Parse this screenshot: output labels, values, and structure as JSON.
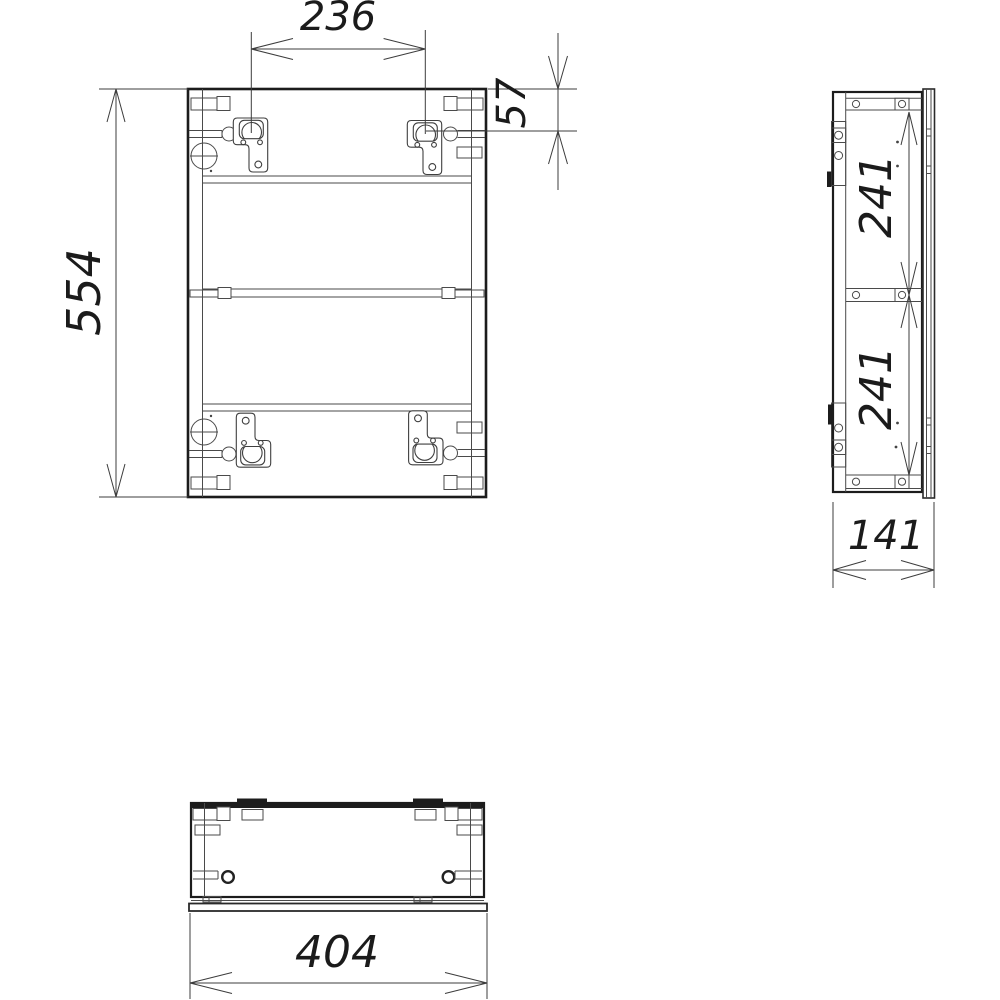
{
  "dimensions": {
    "bracket_spacing": "236",
    "bracket_top_offset": "57",
    "cabinet_height": "554",
    "side_upper_section": "241",
    "side_lower_section": "241",
    "cabinet_depth": "141",
    "cabinet_width": "404"
  },
  "colors": {
    "background": "#ffffff",
    "outline": "#1c1c1c",
    "detail_line": "#4a4a4a",
    "dimension_line": "#3c3c3c"
  }
}
